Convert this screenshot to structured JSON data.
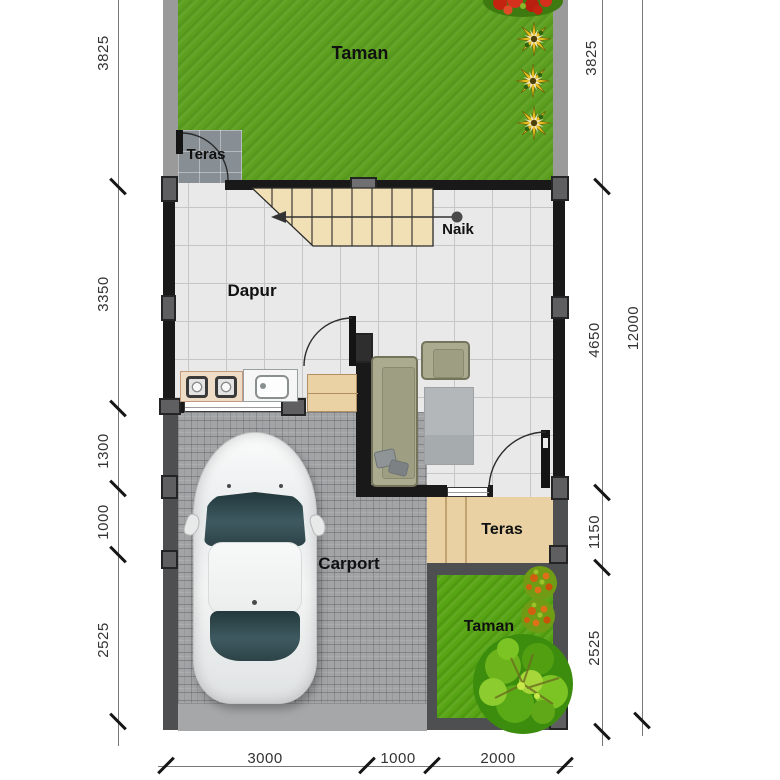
{
  "plan": {
    "rooms": {
      "garden_top": "Taman",
      "terrace_top": "Teras",
      "kitchen": "Dapur",
      "stairs_note": "Naik",
      "carport": "Carport",
      "terrace_bottom": "Teras",
      "garden_bottom": "Taman"
    },
    "dimensions": {
      "left": [
        "3825",
        "3350",
        "1300",
        "1000",
        "2525"
      ],
      "right": [
        "3825",
        "4650",
        "1150",
        "2525"
      ],
      "overall_right": "12000",
      "bottom": [
        "3000",
        "1000",
        "2000"
      ]
    },
    "elements": {
      "stairs": "stairs-up",
      "direction_arrow": "stair-direction-arrow",
      "doors": [
        "terrace-top-door",
        "kitchen-living-door",
        "living-terrace-door"
      ],
      "vegetation": [
        "red-flower-tree",
        "yellow-flower-plants",
        "orange-shrubs",
        "large-tree"
      ],
      "vehicle": "car-top-view"
    },
    "colors": {
      "garden_green": "#5da020",
      "garden_bottom_green": "#57a414",
      "floor_tile": "#e9e9e9",
      "terrace_tile_gray": "#878e94",
      "wall_black": "#191919",
      "stairs_wood": "#f1e0b5",
      "terrace_wood": "#e9d1a3",
      "paver_gray": "#a2a4a6",
      "sofa_olive": "#abab90",
      "boundary_gray": "#9a9a9a"
    }
  }
}
